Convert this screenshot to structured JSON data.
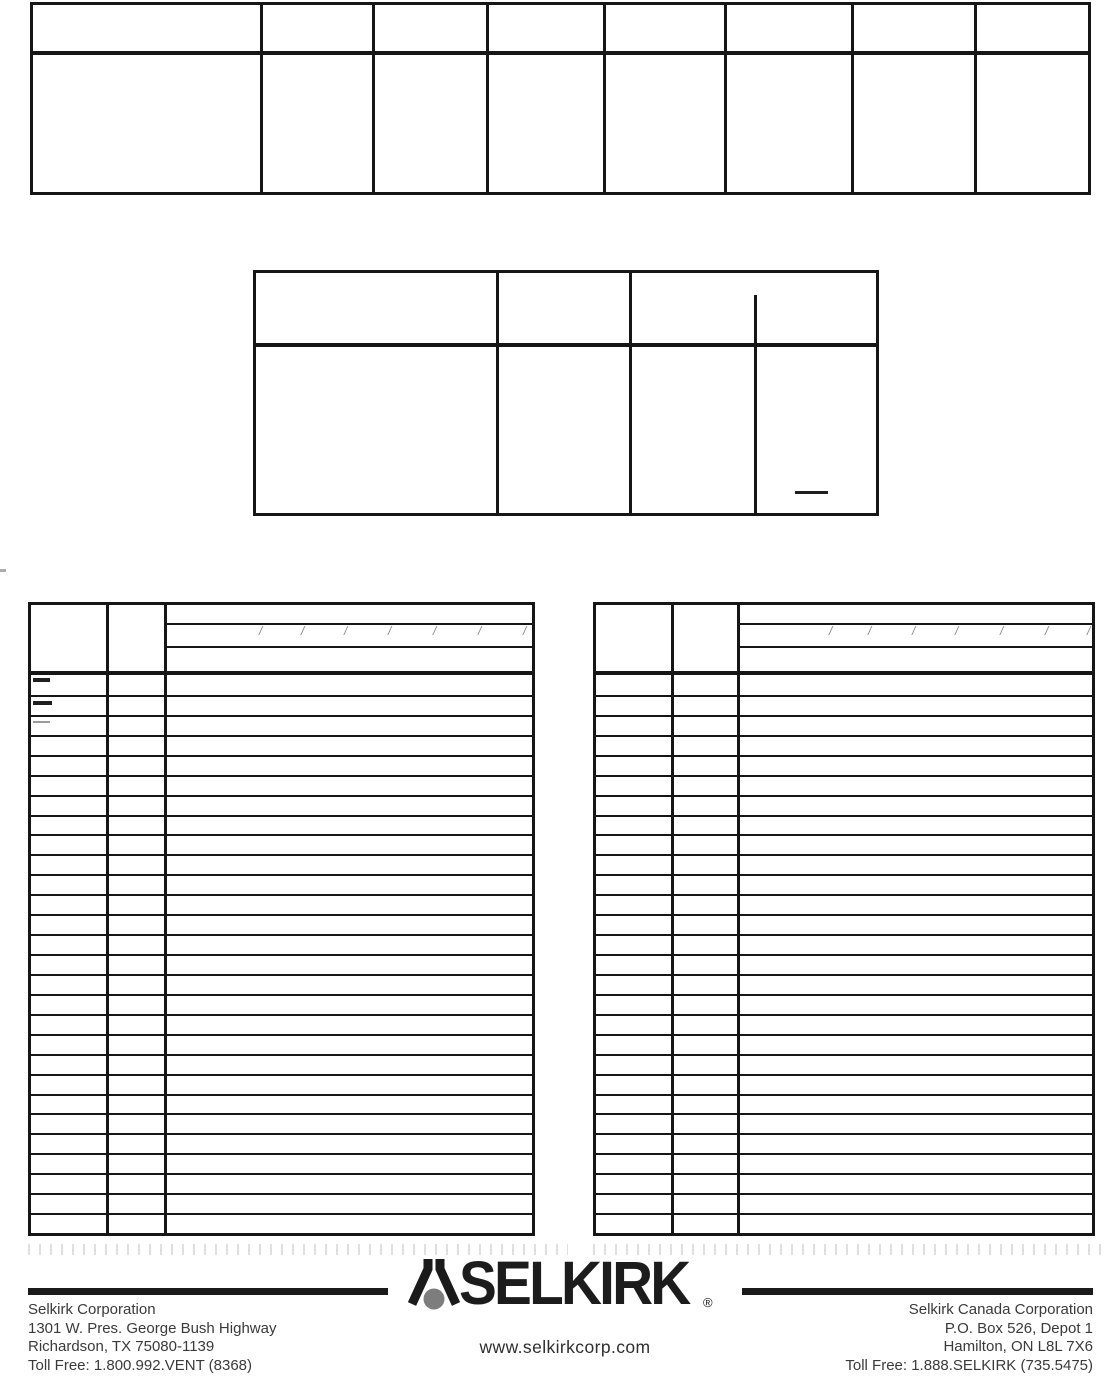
{
  "document": {
    "kind": "scanned manual page with empty part tables",
    "background": "#ffffff",
    "line_color": "#161616"
  },
  "top_table": {
    "x": 30,
    "y": 2,
    "w": 1061,
    "h": 193,
    "border": 3,
    "columns": 8,
    "header_rows": 1,
    "body_rows": 1,
    "content": "empty",
    "header_divider_y": 46,
    "col_dividers": [
      227,
      339,
      453,
      570,
      691,
      818,
      941
    ]
  },
  "middle_table": {
    "x": 253,
    "y": 270,
    "w": 626,
    "h": 246,
    "border": 3,
    "columns": 4,
    "header_rows": 1,
    "body_rows": 1,
    "content": "empty",
    "header_divider_y": 70,
    "col_dividers": [
      240,
      373
    ],
    "partial_divider": {
      "x": 498,
      "top": 22
    },
    "stray_marks": [
      {
        "x": 539,
        "y": 218,
        "w": 33,
        "h": 3,
        "color": "#1f1f1f"
      }
    ]
  },
  "parts_table_left": {
    "x": 28,
    "y": 602,
    "w": 507,
    "h": 634,
    "border": 3,
    "columns": 3,
    "body_rows": 28,
    "content": "empty",
    "header_divider_y": 66,
    "col_dividers": [
      75,
      133
    ],
    "header_bands": {
      "x": 133,
      "ys": [
        18,
        41
      ]
    },
    "header_slashes": {
      "glyph": "/",
      "y": 20,
      "xs": [
        228,
        270,
        313,
        357,
        402,
        447,
        492
      ]
    },
    "stray_marks": [
      {
        "x": 2,
        "y": 73,
        "w": 17,
        "h": 4,
        "color": "#1f1f1f"
      },
      {
        "x": 2,
        "y": 96,
        "w": 19,
        "h": 4,
        "color": "#1f1f1f"
      },
      {
        "x": 2,
        "y": 116,
        "w": 17,
        "h": 2,
        "color": "#9b9b9b"
      }
    ]
  },
  "parts_table_right": {
    "x": 593,
    "y": 602,
    "w": 502,
    "h": 634,
    "border": 3,
    "columns": 3,
    "body_rows": 28,
    "content": "empty",
    "header_divider_y": 66,
    "col_dividers": [
      75,
      141
    ],
    "header_bands": {
      "x": 141,
      "ys": [
        18,
        41
      ]
    },
    "header_slashes": {
      "glyph": "/",
      "y": 20,
      "xs": [
        233,
        272,
        316,
        359,
        404,
        449,
        491
      ]
    }
  },
  "scan_artifacts": {
    "tick_strips": [
      {
        "x": 28,
        "y": 1244,
        "w": 540
      },
      {
        "x": 593,
        "y": 1244,
        "w": 511
      }
    ],
    "margin_mark": {
      "x": 0,
      "y": 569,
      "w": 6,
      "h": 3,
      "color": "#adadad"
    }
  },
  "footer": {
    "rules": [
      {
        "x": 28,
        "y": 1288,
        "w": 360
      },
      {
        "x": 742,
        "y": 1288,
        "w": 351
      }
    ],
    "brand": {
      "name": "SELKIRK",
      "registered_mark": "®",
      "website": "www.selkirkcorp.com",
      "logo_colors": {
        "strokes": "#1a1a1a",
        "dot": "#7d7d7d"
      }
    },
    "left_address": {
      "lines": [
        "Selkirk Corporation",
        "1301 W. Pres. George Bush Highway",
        "Richardson, TX 75080-1139",
        "Toll Free: 1.800.992.VENT (8368)"
      ]
    },
    "right_address": {
      "lines": [
        "Selkirk Canada Corporation",
        "P.O. Box 526, Depot 1",
        "Hamilton, ON L8L 7X6",
        "Toll Free: 1.888.SELKIRK (735.5475)"
      ]
    }
  }
}
